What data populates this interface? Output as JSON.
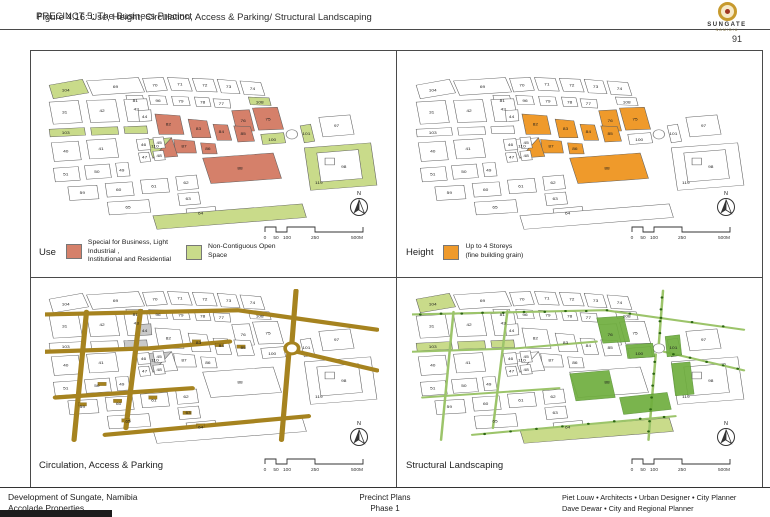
{
  "header": {
    "title_overlay_1": "PRECINCT 5: The Business Precinct",
    "title_overlay_2": "Figure 4.16: Use, Height, Circulation, Access & Parking/ Structural Landscaping",
    "page_number": "91"
  },
  "logo": {
    "name": "SUNGATE",
    "sub": "NAMIBIA"
  },
  "panels": [
    {
      "id": "use",
      "label": "Use",
      "legend": [
        {
          "swatch": "#d5806a",
          "line1": "Special for Business, Light Industrial ,",
          "line2": "Institutional and Residential"
        },
        {
          "swatch": "#c9db8a",
          "line1": "Non-Contiguous Open Space",
          "line2": ""
        }
      ]
    },
    {
      "id": "height",
      "label": "Height",
      "legend": [
        {
          "swatch": "#ef9a2b",
          "line1": "Up to 4 Storeys",
          "line2": "(fine building grain)"
        }
      ]
    },
    {
      "id": "circulation",
      "label": "Circulation, Access & Parking",
      "legend": []
    },
    {
      "id": "landscaping",
      "label": "Structural Landscaping",
      "legend": []
    }
  ],
  "scalebar": {
    "ticks": [
      "0",
      "50",
      "100",
      "250",
      "500M"
    ],
    "xs": [
      6,
      17,
      28,
      56,
      104
    ]
  },
  "north_label": "N",
  "footer": {
    "left_line1": "Development of Sungate, Namibia",
    "left_line2": "Accolade Properties",
    "center_line1": "Precinct Plans",
    "center_line2": "Phase 1",
    "right_line1": "Piet Louw • Architects • Urban Designer • City Planner",
    "right_line2": "Dave Dewar • City and Regional Planner"
  },
  "map": {
    "colors": {
      "open": "#c9db8a",
      "special": "#d5806a",
      "storeys": "#ef9a2b",
      "road": "#a6831f",
      "bright": "#6fae3e",
      "dot": "#2d6613",
      "hatch": "#c9c9c9",
      "stroke": "#5f5f5f",
      "label": "#1d1d1d"
    },
    "parcels": [
      {
        "id": "p104",
        "label": "104",
        "pts": "4,12 36,5 42,21 8,28",
        "lx": 20,
        "ly": 18
      },
      {
        "id": "p69",
        "label": "69",
        "pts": "40,7 90,3 96,20 46,24",
        "lx": 68,
        "ly": 14
      },
      {
        "id": "p70",
        "label": "70",
        "pts": "94,4 114,3 118,18 98,20",
        "lx": 106,
        "ly": 12
      },
      {
        "id": "p71",
        "label": "71",
        "pts": "118,3 138,4 142,19 122,18",
        "lx": 130,
        "ly": 11
      },
      {
        "id": "p72",
        "label": "72",
        "pts": "142,4 162,5 166,20 146,19",
        "lx": 154,
        "ly": 12
      },
      {
        "id": "p73",
        "label": "73",
        "pts": "166,5 184,7 188,22 170,21",
        "lx": 177,
        "ly": 14
      },
      {
        "id": "p74",
        "label": "74",
        "pts": "188,7 208,9 212,24 192,23",
        "lx": 200,
        "ly": 16
      },
      {
        "id": "p108",
        "label": "108",
        "pts": "196,26 216,27 218,36 198,35",
        "lx": 207,
        "ly": 32
      },
      {
        "id": "p81",
        "label": "81",
        "pts": "78,24 94,24 96,34 80,35",
        "lx": 87,
        "ly": 30
      },
      {
        "id": "p96",
        "label": "96",
        "pts": "100,24 116,25 118,35 102,35",
        "lx": 109,
        "ly": 30
      },
      {
        "id": "p79",
        "label": "79",
        "pts": "122,25 138,26 140,36 124,36",
        "lx": 131,
        "ly": 31
      },
      {
        "id": "p78",
        "label": "78",
        "pts": "144,26 158,27 160,37 146,37",
        "lx": 152,
        "ly": 32
      },
      {
        "id": "p77",
        "label": "77",
        "pts": "162,28 178,29 179,39 164,38",
        "lx": 170,
        "ly": 34
      },
      {
        "id": "p75",
        "label": "75",
        "pts": "200,39 224,38 230,64 206,65",
        "lx": 215,
        "ly": 52
      },
      {
        "id": "p76",
        "label": "76",
        "pts": "180,42 197,41 202,66 185,67",
        "lx": 191,
        "ly": 54
      },
      {
        "id": "p31",
        "label": "31",
        "pts": "4,32 32,30 36,56 8,58",
        "lx": 19,
        "ly": 44
      },
      {
        "id": "p42",
        "label": "42",
        "pts": "40,30 68,29 72,55 44,56",
        "lx": 55,
        "ly": 42
      },
      {
        "id": "p43",
        "label": "43",
        "pts": "76,29 98,28 102,54 80,55",
        "lx": 88,
        "ly": 40
      },
      {
        "id": "p44",
        "label": "44",
        "pts": "90,42 102,41 103,54 91,55",
        "lx": 96,
        "ly": 49
      },
      {
        "id": "p103",
        "label": "103",
        "pts": "4,64 38,62 39,71 5,73",
        "lx": 20,
        "ly": 68
      },
      {
        "id": "s1",
        "label": "",
        "pts": "44,62 70,61 71,70 45,71",
        "lx": 0,
        "ly": 0
      },
      {
        "id": "s2",
        "label": "",
        "pts": "76,61 98,60 99,69 77,69",
        "lx": 0,
        "ly": 0
      },
      {
        "id": "p82",
        "label": "82",
        "pts": "106,46 130,48 134,70 110,70",
        "lx": 119,
        "ly": 58
      },
      {
        "id": "p83",
        "label": "83",
        "pts": "138,52 156,54 160,74 142,74",
        "lx": 148,
        "ly": 63
      },
      {
        "id": "p84",
        "label": "84",
        "pts": "162,58 176,59 180,77 166,77",
        "lx": 170,
        "ly": 67
      },
      {
        "id": "p85",
        "label": "85",
        "pts": "182,60 198,61 202,78 186,79",
        "lx": 191,
        "ly": 69
      },
      {
        "id": "p87",
        "label": "87",
        "pts": "124,76 144,78 146,92 126,92",
        "lx": 134,
        "ly": 84
      },
      {
        "id": "p86",
        "label": "86",
        "pts": "150,80 164,81 166,93 152,93",
        "lx": 157,
        "ly": 87
      },
      {
        "id": "p110g",
        "label": "110",
        "pts": "98,76 122,74 104,98",
        "lx": 106,
        "ly": 84
      },
      {
        "id": "p110r",
        "label": "",
        "pts": "122,74 128,96 104,98",
        "lx": 0,
        "ly": 0
      },
      {
        "id": "p88",
        "label": "88",
        "pts": "152,98 220,92 228,122 160,128",
        "lx": 188,
        "ly": 110
      },
      {
        "id": "p100",
        "label": "100",
        "pts": "208,70 230,68 232,80 210,82",
        "lx": 219,
        "ly": 76
      },
      {
        "id": "p101",
        "label": "101",
        "pts": "246,60 256,58 260,78 250,80",
        "lx": 252,
        "ly": 69
      },
      {
        "id": "p97",
        "label": "97",
        "pts": "264,50 294,47 298,70 268,73",
        "lx": 281,
        "ly": 60
      },
      {
        "id": "p119",
        "label": "119",
        "pts": "250,86 314,80 320,130 256,136",
        "lx": 264,
        "ly": 127
      },
      {
        "id": "p98",
        "label": "98",
        "pts": "262,92 302,88 306,122 266,126",
        "lx": 288,
        "ly": 108
      },
      {
        "id": "p40",
        "label": "40",
        "pts": "6,80 32,78 35,100 9,102",
        "lx": 20,
        "ly": 90
      },
      {
        "id": "p41",
        "label": "41",
        "pts": "40,77 68,75 71,97 43,99",
        "lx": 54,
        "ly": 87
      },
      {
        "id": "p46",
        "label": "46",
        "pts": "88,76 100,75 102,88 90,89",
        "lx": 95,
        "ly": 82
      },
      {
        "id": "p45",
        "label": "45",
        "pts": "104,74 114,73 116,86 106,87",
        "lx": 110,
        "ly": 80
      },
      {
        "id": "p47",
        "label": "47",
        "pts": "90,92 100,91 102,102 92,103",
        "lx": 96,
        "ly": 97
      },
      {
        "id": "p48",
        "label": "48",
        "pts": "104,90 114,89 116,100 106,101",
        "lx": 110,
        "ly": 95
      },
      {
        "id": "p51",
        "label": "51",
        "pts": "8,110 32,108 34,124 10,126",
        "lx": 20,
        "ly": 117
      },
      {
        "id": "p50",
        "label": "50",
        "pts": "38,107 62,105 64,121 40,123",
        "lx": 50,
        "ly": 114
      },
      {
        "id": "p49",
        "label": "49",
        "pts": "68,104 80,103 82,119 70,120",
        "lx": 74,
        "ly": 112
      },
      {
        "id": "p59",
        "label": "59",
        "pts": "22,132 50,130 52,146 24,148",
        "lx": 36,
        "ly": 139
      },
      {
        "id": "p60",
        "label": "60",
        "pts": "58,128 84,126 86,142 60,144",
        "lx": 71,
        "ly": 135
      },
      {
        "id": "p61",
        "label": "61",
        "pts": "92,124 118,122 120,138 94,140",
        "lx": 105,
        "ly": 131
      },
      {
        "id": "p62",
        "label": "62",
        "pts": "126,120 146,118 148,134 128,136",
        "lx": 136,
        "ly": 127
      },
      {
        "id": "p63",
        "label": "63",
        "pts": "128,140 148,138 150,152 130,154",
        "lx": 138,
        "ly": 146
      },
      {
        "id": "p65",
        "label": "65",
        "pts": "60,150 100,147 102,162 62,165",
        "lx": 80,
        "ly": 156
      },
      {
        "id": "p64",
        "label": "64",
        "pts": "136,158 164,155 166,168 138,171",
        "lx": 150,
        "ly": 163
      },
      {
        "id": "osband",
        "label": "",
        "pts": "104,166 248,152 252,168 108,182",
        "lx": 0,
        "ly": 0
      }
    ],
    "roundabout": {
      "cx": 238,
      "cy": 70,
      "r": 5.5
    },
    "building": {
      "x": 270,
      "y": 98,
      "w": 9,
      "h": 8
    },
    "roads": [
      "M0,30 L186,25 L320,48",
      "M242,2 L238,64",
      "M235,77 L228,178",
      "M0,74 L100,70 L178,62",
      "M40,27 L28,178",
      "M92,26 L78,164",
      "M243,74 L320,96",
      "M10,128 L142,117",
      "M58,172 L254,150"
    ],
    "fills": {
      "use": {
        "open": [
          "p104",
          "p108",
          "p103",
          "s1",
          "s2",
          "p100",
          "p101",
          "p110g",
          "p119",
          "osband"
        ],
        "special": [
          "p75",
          "p76",
          "p82",
          "p83",
          "p84",
          "p85",
          "p86",
          "p87",
          "p88",
          "p110r"
        ]
      },
      "height": {
        "storeys": [
          "p75",
          "p76",
          "p82",
          "p83",
          "p84",
          "p85",
          "p86",
          "p87",
          "p88",
          "p110r"
        ]
      },
      "circulation": {
        "hatch": [
          "p44",
          "s2",
          "p110g"
        ]
      },
      "landscaping": {
        "open": [
          "p104",
          "p103",
          "s1",
          "s2",
          "osband"
        ]
      }
    },
    "structures": [
      [
        146,
        62
      ],
      [
        168,
        66
      ],
      [
        189,
        68
      ],
      [
        36,
        136
      ],
      [
        70,
        132
      ],
      [
        104,
        128
      ],
      [
        137,
        146
      ],
      [
        150,
        161
      ],
      [
        78,
        155
      ],
      [
        55,
        112
      ]
    ],
    "patches": [
      "178,34 204,32 210,62 184,64",
      "206,66 232,64 234,80 208,82",
      "244,56 258,54 260,78 246,80",
      "152,100 190,96 196,128 158,132",
      "250,88 268,86 272,124 254,126",
      "200,128 246,122 250,142 204,148"
    ],
    "dots": [
      [
        8,
        30
      ],
      [
        28,
        29
      ],
      [
        48,
        29
      ],
      [
        68,
        28
      ],
      [
        88,
        28
      ],
      [
        108,
        27
      ],
      [
        128,
        27
      ],
      [
        148,
        26
      ],
      [
        168,
        26
      ],
      [
        188,
        25
      ],
      [
        210,
        29
      ],
      [
        240,
        34
      ],
      [
        270,
        39
      ],
      [
        300,
        44
      ],
      [
        241,
        10
      ],
      [
        240,
        24
      ],
      [
        239,
        38
      ],
      [
        239,
        52
      ],
      [
        234,
        86
      ],
      [
        233,
        100
      ],
      [
        232,
        114
      ],
      [
        231,
        128
      ],
      [
        230,
        142
      ],
      [
        229,
        156
      ],
      [
        228,
        168
      ],
      [
        252,
        77
      ],
      [
        268,
        81
      ],
      [
        284,
        86
      ],
      [
        300,
        90
      ],
      [
        314,
        94
      ],
      [
        70,
        171
      ],
      [
        95,
        168
      ],
      [
        120,
        165
      ],
      [
        145,
        162
      ],
      [
        170,
        159
      ],
      [
        195,
        156
      ],
      [
        220,
        153
      ],
      [
        243,
        151
      ]
    ]
  }
}
